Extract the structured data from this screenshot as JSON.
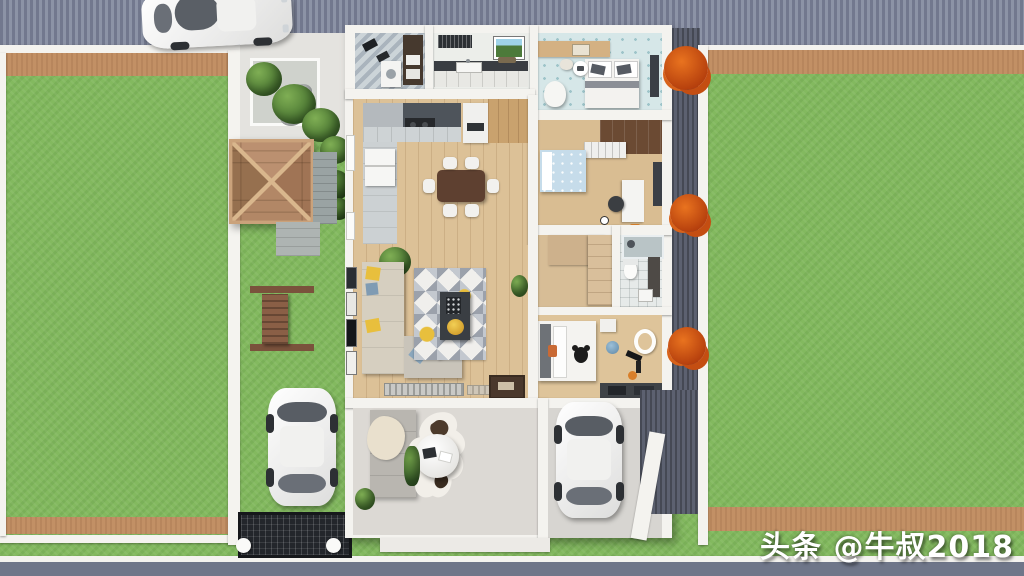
{
  "watermark": {
    "text": "头条 @牛叔2018"
  },
  "palette": {
    "grass": "#83b95f",
    "road": "#858ca0",
    "dirt": "#c29065",
    "wall_white": "#f4f3ef",
    "wood_floor": "#dcc197",
    "gazebo_wood": "#a87e5d",
    "accent_orange": "#d4571e",
    "accent_yellow": "#e8bf3d",
    "accent_blue": "#b9d4e4",
    "side_passage": "#5c6170"
  },
  "scene": {
    "type": "3d-floorplan-top-down-render",
    "areas": [
      "street-top",
      "street-bottom",
      "left-garden",
      "right-garden",
      "courtyard",
      "laundry-room",
      "small-kitchen",
      "bedroom-1",
      "kitchen-dining-room",
      "kids-bedroom",
      "hallway-wardrobe",
      "bathroom",
      "master-bedroom",
      "living-room",
      "patio",
      "carport"
    ],
    "objects": [
      "white-car-street",
      "white-car-courtyard",
      "white-car-carport",
      "wooden-gazebo",
      "garden-bench",
      "driveway-grate",
      "dining-table-six-chairs",
      "l-shaped-sofa",
      "geometric-rug",
      "cowhide-rug",
      "round-coffee-table",
      "double-bed",
      "kids-bed",
      "panda-bed",
      "toilet",
      "shower",
      "orange-shrubs",
      "green-trees"
    ]
  }
}
